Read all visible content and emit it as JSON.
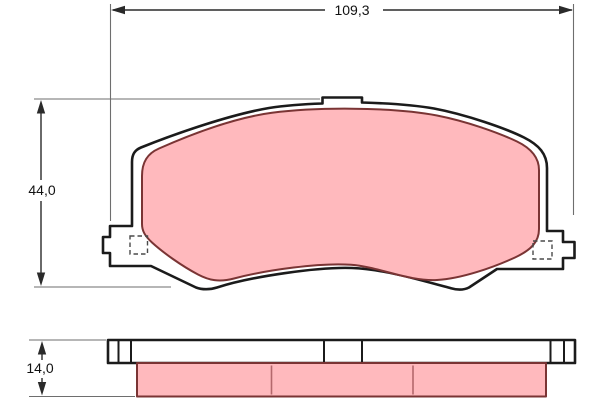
{
  "drawing": {
    "width_dim": "109,3",
    "height_dim": "44,0",
    "thickness_dim": "14,0"
  },
  "colors": {
    "friction_fill": "#ffb9bd",
    "friction_border": "#7a3434",
    "plate_outline": "#1b1b1b",
    "dimension_line": "#2a2a2a",
    "extension_line": "#6e6e6e",
    "slot_line": "#b4686c",
    "hole_dash": "#4a4a4a",
    "background": "#ffffff"
  }
}
